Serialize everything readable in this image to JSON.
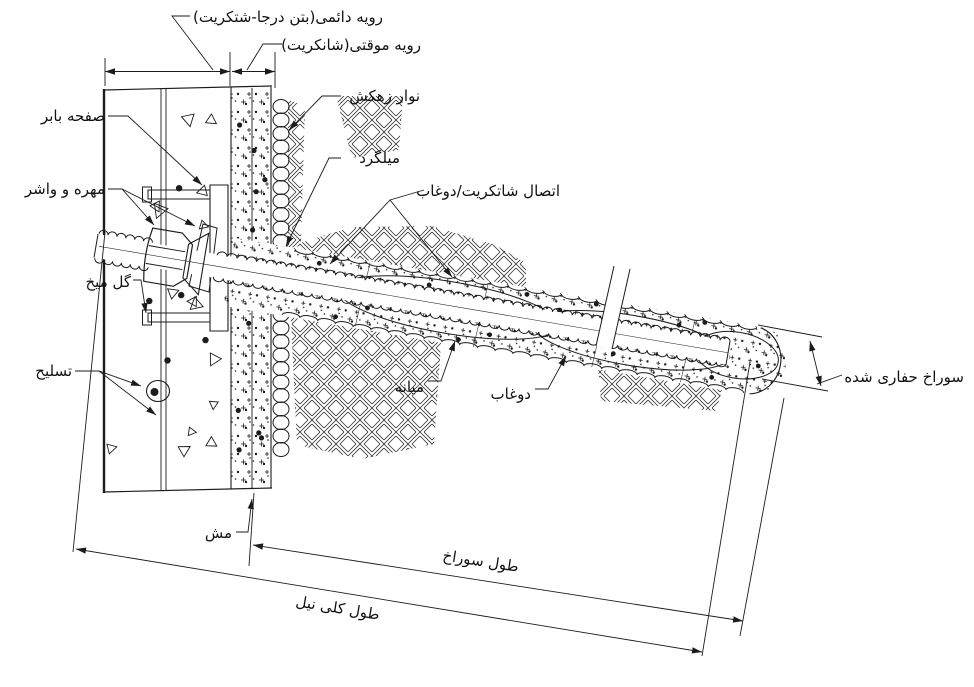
{
  "diagram": {
    "type": "soil-nail-wall-detail-drawing",
    "ink_color": "#1c1c1c",
    "background_color": "#ffffff",
    "labels": {
      "permanent_facing": "رویه دائمی(بتن درجا-شتکریت)",
      "temporary_facing": "رویه موقتی(شانکریت)",
      "drainage_strip": "نوار زهکش",
      "rebar": "میلگرد",
      "shotcrete_grout_connection": "اتصال شاتکریت/دوغاب",
      "bearing_plate": "صفحه بابر",
      "nut_and_washer": "مهره و واشر",
      "headed_stud": "گل میخ",
      "reinforcement": "تسلیح",
      "mesh": "مش",
      "centralizer": "میانه",
      "grout": "دوغاب",
      "drilled_hole": "سوراخ حفاری شده",
      "hole_length": "طول سوراخ",
      "nail_total_length": "طول کلی نیل"
    }
  }
}
